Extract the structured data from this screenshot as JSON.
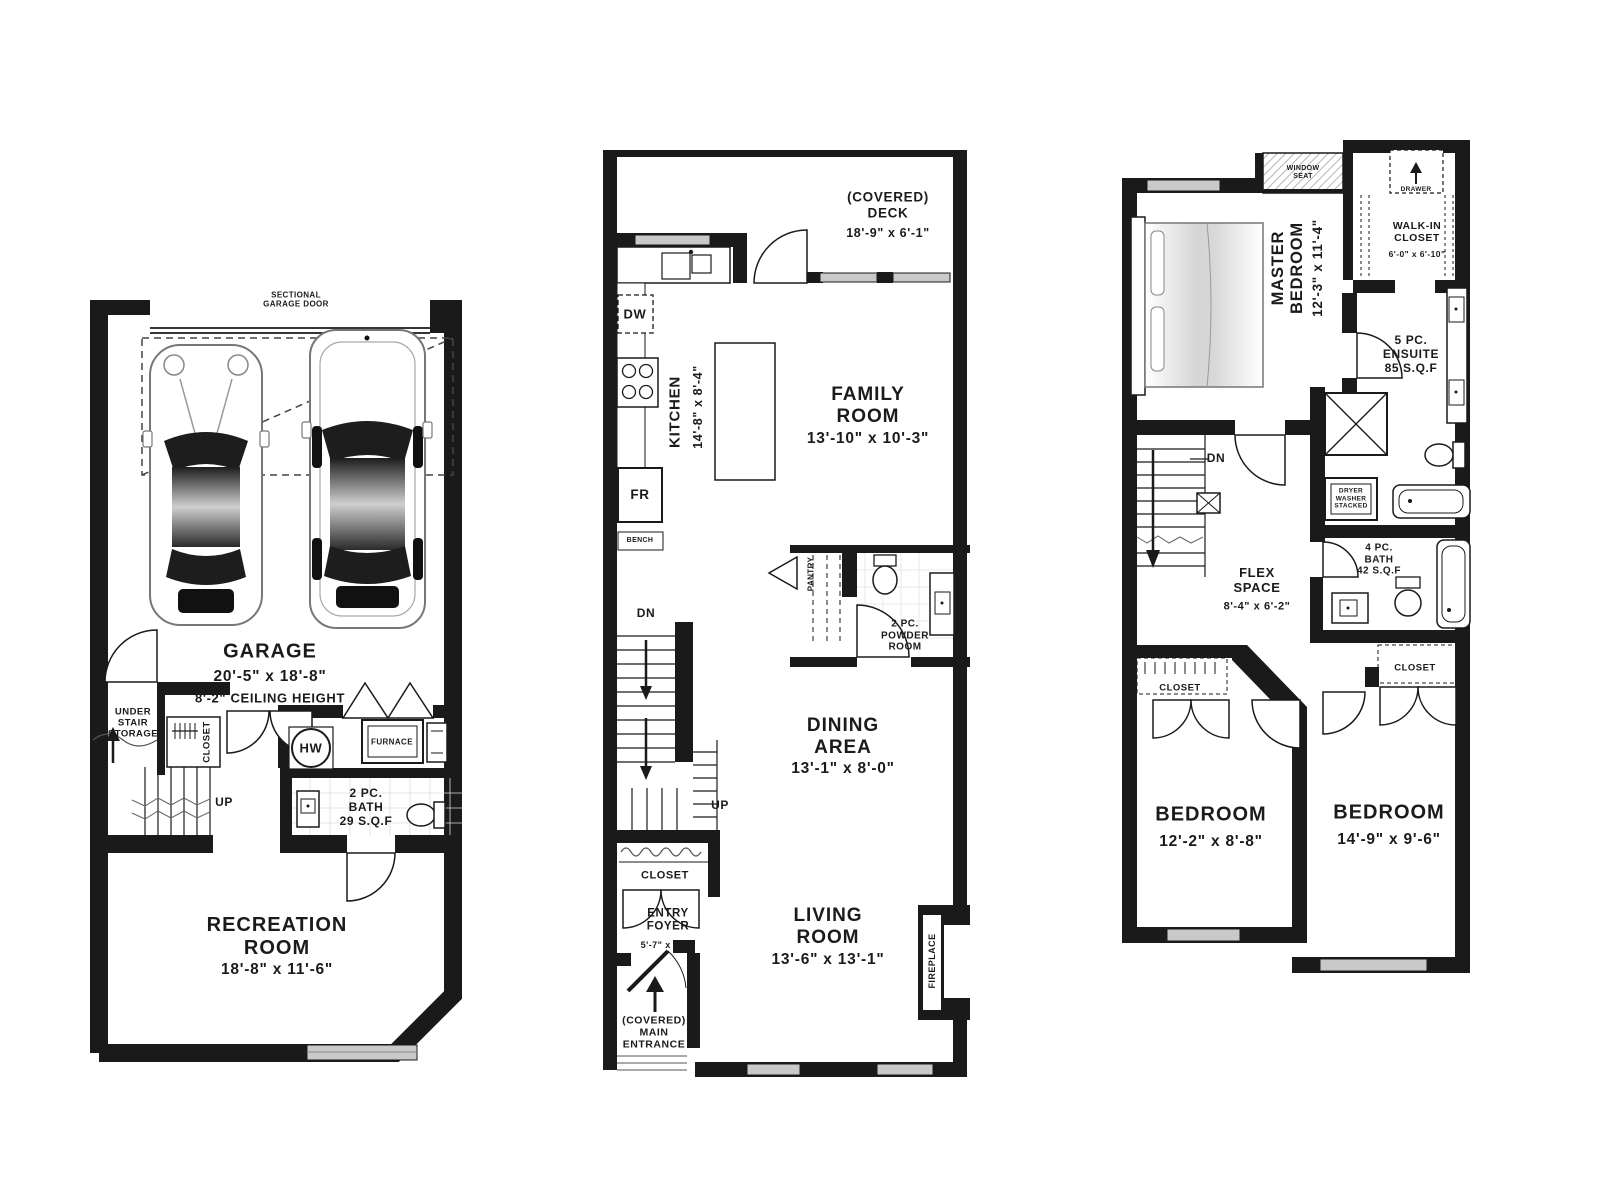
{
  "colors": {
    "ink": "#1a1a1a",
    "window_gray": "#c9c9c9",
    "paper": "#ffffff"
  },
  "floors": {
    "basement": {
      "garage_door": "SECTIONAL\nGARAGE DOOR",
      "garage": {
        "name": "GARAGE",
        "dims": "20'-5\" x 18'-8\"",
        "note": "8'-2\" CEILING HEIGHT"
      },
      "under_stair_storage": "UNDER\nSTAIR\nSTORAGE",
      "closet": "CLOSET",
      "stairs_up": "UP",
      "hot_water": "HW",
      "furnace": "FURNACE",
      "bath": "2 PC.\nBATH\n29 S.Q.F",
      "recreation": {
        "name": "RECREATION\nROOM",
        "dims": "18'-8\" x 11'-6\""
      }
    },
    "main": {
      "deck": {
        "name": "(COVERED)\nDECK",
        "dims": "18'-9\" x 6'-1\""
      },
      "dishwasher": "DW",
      "kitchen": {
        "name": "KITCHEN",
        "dims": "14'-8\" x 8'-4\""
      },
      "fridge": "FR",
      "bench": "BENCH",
      "family": {
        "name": "FAMILY\nROOM",
        "dims": "13'-10\" x 10'-3\""
      },
      "pantry": "PANTRY",
      "powder": "2 PC.\nPOWDER\nROOM",
      "stairs_dn": "DN",
      "stairs_up": "UP",
      "dining": {
        "name": "DINING\nAREA",
        "dims": "13'-1\" x 8'-0\""
      },
      "closet": "CLOSET",
      "foyer": {
        "name": "ENTRY\nFOYER",
        "dims": "5'-7\" x 5'-3\""
      },
      "entrance": "(COVERED)\nMAIN\nENTRANCE",
      "living": {
        "name": "LIVING\nROOM",
        "dims": "13'-6\" x 13'-1\""
      },
      "fireplace": "FIREPLACE"
    },
    "upper": {
      "window_seat": "WINDOW\nSEAT",
      "drawer": "DRAWER",
      "master": {
        "name": "MASTER\nBEDROOM",
        "dims": "12'-3\" x 11'-4\""
      },
      "walk_in": {
        "name": "WALK-IN\nCLOSET",
        "dims": "6'-0\" x 6'-10\""
      },
      "ensuite": "5 PC.\nENSUITE\n85 S.Q.F",
      "stairs_dn": "DN",
      "flex": {
        "name": "FLEX\nSPACE",
        "dims": "8'-4\" x 6'-2\""
      },
      "laundry": "DRYER\nWASHER\nSTACKED",
      "bath": "4 PC.\nBATH\n42 S.Q.F",
      "closet_left": "CLOSET",
      "closet_right": "CLOSET",
      "bedroom_left": {
        "name": "BEDROOM",
        "dims": "12'-2\" x 8'-8\""
      },
      "bedroom_right": {
        "name": "BEDROOM",
        "dims": "14'-9\" x 9'-6\""
      }
    }
  }
}
